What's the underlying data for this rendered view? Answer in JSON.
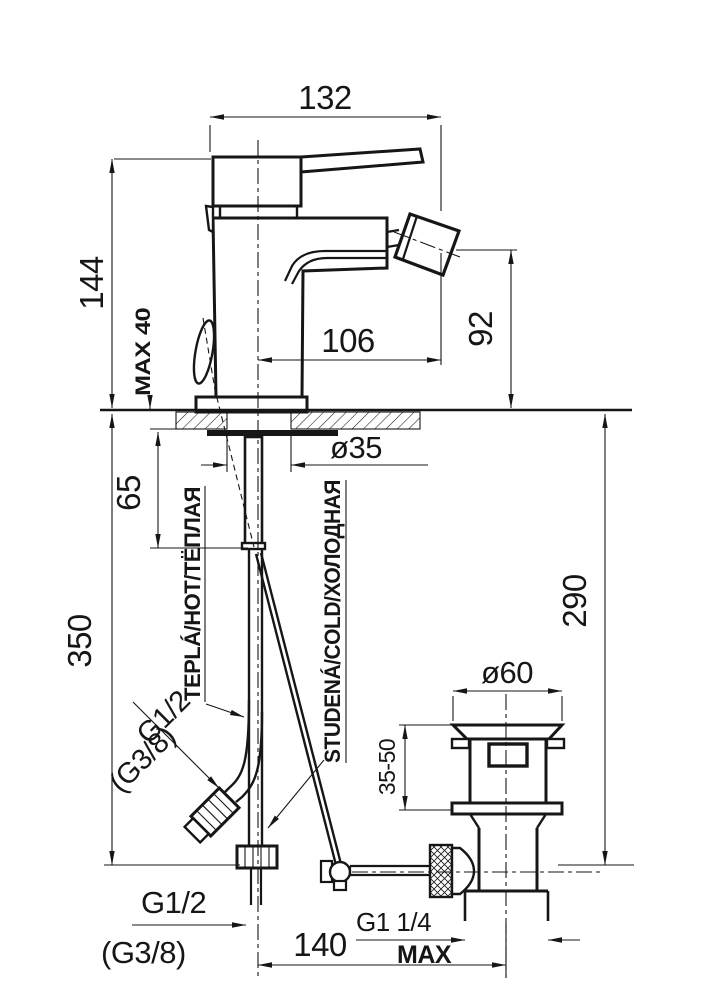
{
  "drawing": {
    "dimensions": {
      "width_132": "132",
      "height_144": "144",
      "max_deck": "MAX 40",
      "reach_106": "106",
      "spout_height_92": "92",
      "shank_dia": "ø35",
      "shank_len_65": "65",
      "supply_len_350": "350",
      "rod_len_290": "290",
      "flange_dia": "ø60",
      "clamp_range": "35-50",
      "centres_140": "140",
      "max_note": "MAX"
    },
    "threads": {
      "hose_rotated": "G1/2",
      "hose_rotated_alt": "(G3/8)",
      "supply_bottom": "G1/2",
      "supply_bottom_alt": "(G3/8)",
      "waste": "G1 1/4"
    },
    "water_labels": {
      "hot": "TEPLÁ/HOT/ТЁПЛАЯ",
      "cold": "STUDENÁ/COLD/ХОЛОДНАЯ"
    }
  }
}
